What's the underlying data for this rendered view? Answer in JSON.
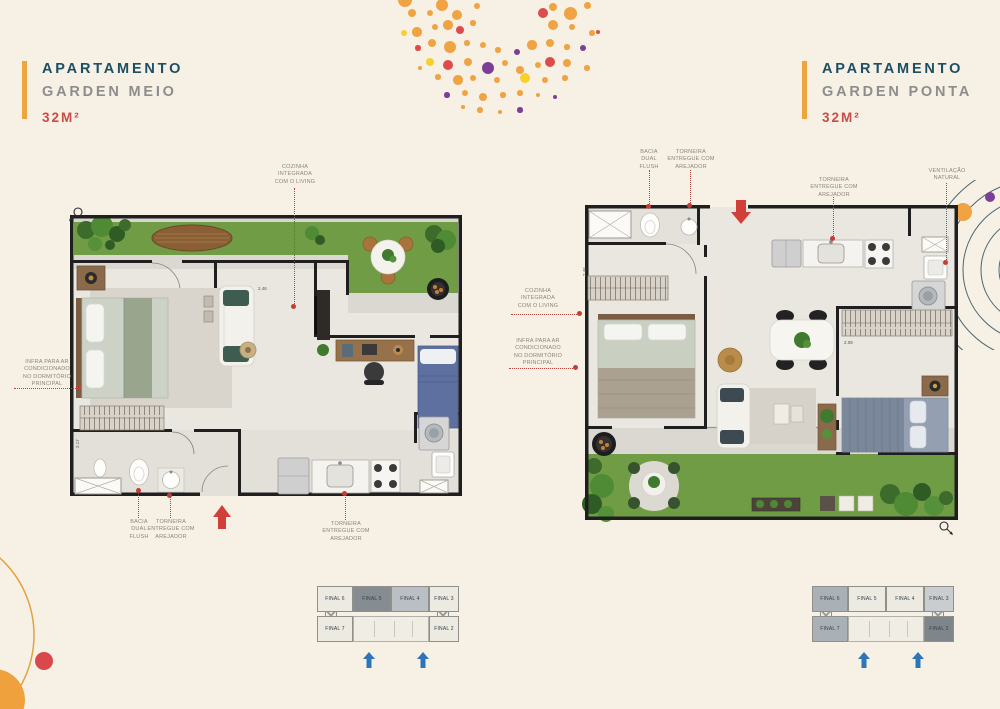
{
  "colors": {
    "background": "#f7f0e4",
    "accent_bar": "#eda63e",
    "title_navy": "#1c4f63",
    "title_gray": "#8d8d8d",
    "area_red": "#cb4b45",
    "annotation_red": "#b5443c",
    "annotation_text": "#8b857c",
    "arrow_red": "#d23f38",
    "arrow_blue": "#2e74b8",
    "grass_green": "#6f9c45",
    "wall_black": "#1f1f1f",
    "dots": {
      "orange": "#f0a342",
      "red": "#dd4b4c",
      "yellow": "#f8d02c",
      "purple": "#7b3f97"
    }
  },
  "left_unit": {
    "title": "APARTAMENTO",
    "subtitle": "GARDEN MEIO",
    "area": "32M²",
    "annotations": {
      "cozinha": "COZINHA\nINTEGRADA\nCOM O LIVING",
      "infra": "INFRA PARA AR\nCONDICIONADO\nNO DORMITÓRIO\nPRINCIPAL",
      "bacia": "BACIA\nDUAL\nFLUSH",
      "torneira_banheiro": "TORNEIRA\nENTREGUE COM\nAREJADOR",
      "torneira_cozinha": "TORNEIRA\nENTREGUE COM\nAREJADOR"
    },
    "dimensions": {
      "d1": "2.46",
      "d2": "2.17"
    },
    "keyplan": {
      "top_units": [
        "FINAL 6",
        "FINAL 5",
        "FINAL 4",
        "FINAL 3"
      ],
      "bottom_units": [
        "FINAL 7",
        "FINAL 2"
      ],
      "highlighted": [
        "FINAL 5",
        "FINAL 4"
      ]
    }
  },
  "right_unit": {
    "title": "APARTAMENTO",
    "subtitle": "GARDEN PONTA",
    "area": "32M²",
    "annotations": {
      "bacia": "BACIA\nDUAL\nFLUSH",
      "torneira_banheiro": "TORNEIRA\nENTREGUE COM\nAREJADOR",
      "torneira_cozinha": "TORNEIRA\nENTREGUE COM\nAREJADOR",
      "ventilacao": "VENTILAÇÃO\nNATURAL",
      "cozinha": "COZINHA\nINTEGRADA\nCOM O LIVING",
      "infra": "INFRA PARA AR\nCONDICIONADO\nNO DORMITÓRIO\nPRINCIPAL"
    },
    "dimensions": {
      "d1": "2.46",
      "d2": "2.08"
    },
    "keyplan": {
      "top_units": [
        "FINAL 6",
        "FINAL 5",
        "FINAL 4",
        "FINAL 3"
      ],
      "bottom_units": [
        "FINAL 7",
        "FINAL 2"
      ],
      "highlighted": [
        "FINAL 6",
        "FINAL 7",
        "FINAL 3",
        "FINAL 2"
      ]
    }
  }
}
